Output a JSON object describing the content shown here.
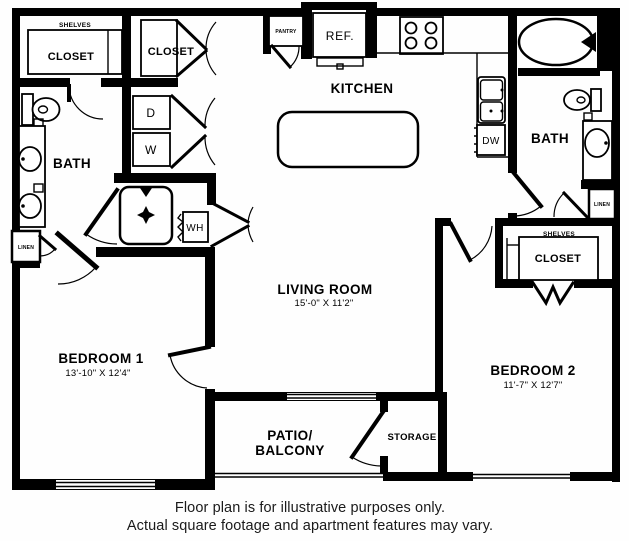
{
  "labels": {
    "shelves_left": "SHELVES",
    "closet_left": "CLOSET",
    "closet_hall": "CLOSET",
    "pantry": "PANTRY",
    "refrigerator": "REF.",
    "kitchen": "KITCHEN",
    "dishwasher": "DW",
    "bath_right": "BATH",
    "linen_right": "LINEN",
    "shelves_right": "SHELVES",
    "closet_bed2": "CLOSET",
    "bedroom2": "BEDROOM 2",
    "bedroom2_dims": "11'-7\" X 12'7\"",
    "dryer": "D",
    "washer": "W",
    "water_heater": "WH",
    "bath_left": "BATH",
    "linen_left": "LINEN",
    "living": "LIVING ROOM",
    "living_dims": "15'-0\" X 11'2\"",
    "bedroom1": "BEDROOM 1",
    "bedroom1_dims": "13'-10\" X 12'4\"",
    "patio_line1": "PATIO/",
    "patio_line2": "BALCONY",
    "storage": "STORAGE"
  },
  "disclaimer": {
    "line1": "Floor plan is for illustrative purposes only.",
    "line2": "Actual square footage and apartment features may vary."
  },
  "colors": {
    "wall": "#000000",
    "background": "#ffffff",
    "text": "#000000"
  }
}
